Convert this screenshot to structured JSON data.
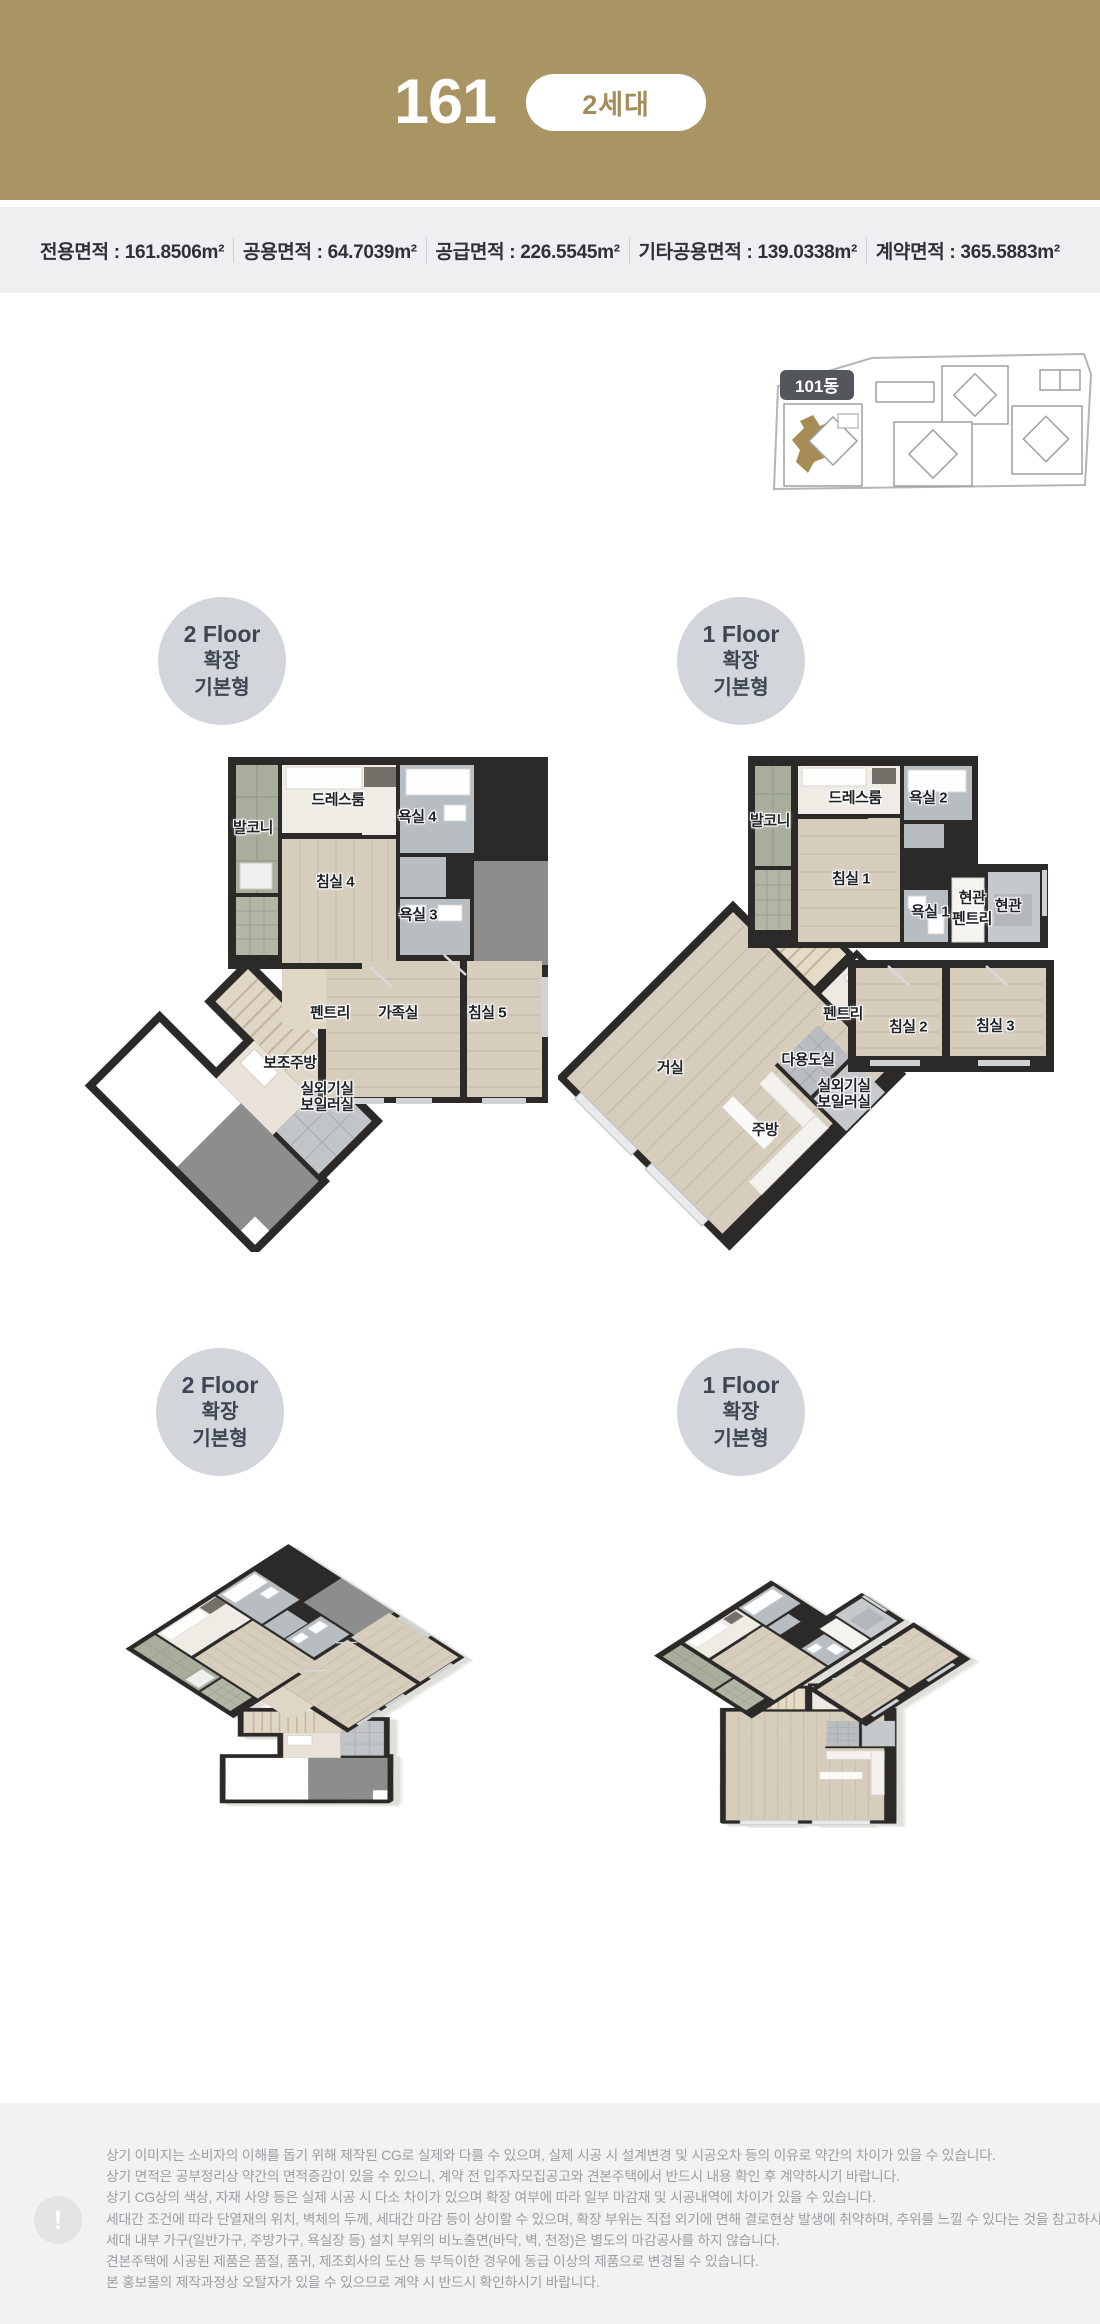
{
  "header": {
    "unit_type": "161",
    "badge_label": "2세대",
    "bg_color": "#a99464",
    "badge_text_color": "#a28c59"
  },
  "area_bar": {
    "items": [
      "전용면적 : 161.8506m²",
      "공용면적 : 64.7039m²",
      "공급면적 : 226.5545m²",
      "기타공용면적 : 139.0338m²",
      "계약면적 : 365.5883m²"
    ]
  },
  "site_map": {
    "building_label": "101동",
    "highlight_color": "#a58d55"
  },
  "floor_badges": {
    "f2": {
      "line1": "2 Floor",
      "line2": "확장",
      "line3": "기본형"
    },
    "f1": {
      "line1": "1 Floor",
      "line2": "확장",
      "line3": "기본형"
    }
  },
  "plan_2f": {
    "rooms": [
      "드레스룸",
      "발코니",
      "욕실 4",
      "침실 4",
      "욕실 3",
      "펜트리",
      "가족실",
      "침실 5",
      "보조주방",
      "실외기실",
      "보일러실"
    ]
  },
  "plan_1f": {
    "rooms": [
      "발코니",
      "드레스룸",
      "욕실 2",
      "침실 1",
      "욕실 1",
      "현관",
      "펜트리",
      "현관",
      "펜트리",
      "침실 2",
      "침실 3",
      "거실",
      "다용도실",
      "실외기실",
      "보일러실",
      "주방"
    ]
  },
  "disclaimer": {
    "icon": "!",
    "lines": [
      "상기 이미지는 소비자의 이해를 돕기 위해 제작된 CG로 실제와 다를 수 있으며, 실제 시공 시 설계변경 및 시공오차 등의 이유로 약간의 차이가 있을 수 있습니다.",
      "상기 면적은 공부정리상 약간의 면적증감이 있을 수 있으니, 계약 전 입주자모집공고와 견본주택에서 반드시 내용 확인 후 계약하시기 바랍니다.",
      "상기 CG상의 색상, 자재 사양 등은 실제 시공 시 다소 차이가 있으며 확장 여부에 따라 일부 마감재 및 시공내역에 차이가 있을 수 있습니다.",
      "세대간 조건에 따라 단열재의 위치, 벽체의 두께, 세대간 마감 등이 상이할 수 있으며, 확장 부위는 직접 외기에 면해 결로현상 발생에 취약하며, 추위를 느낄 수 있다는 것을 참고하시기 바랍니다.",
      "세대 내부 가구(일반가구, 주방가구, 욕실장 등) 설치 부위의 비노출면(바닥, 벽, 천정)은 별도의 마감공사를 하지 않습니다.",
      "견본주택에 시공된 제품은 품절, 품귀, 제조회사의 도산 등 부득이한 경우에 동급 이상의 제품으로 변경될 수 있습니다.",
      "본 홍보물의 제작과정상 오탈자가 있을 수 있으므로 계약 시 반드시 확인하시기 바랍니다."
    ]
  }
}
